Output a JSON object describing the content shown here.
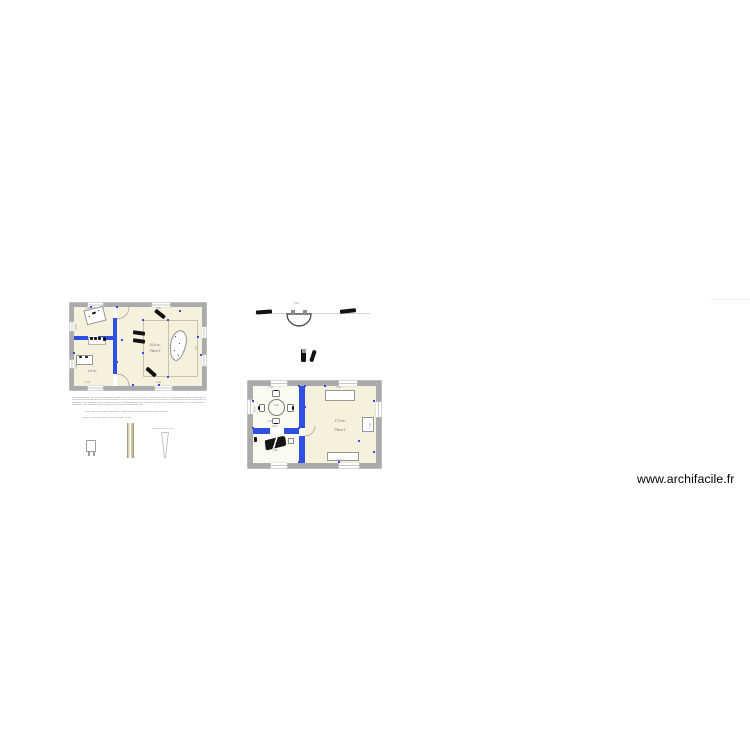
{
  "watermark": {
    "text": "www.archifacile.fr"
  },
  "plan1": {
    "main_room": {
      "area": "16,6 m²",
      "name": "Pièce 2"
    },
    "bottom_room": {
      "area": "4,9 m²"
    },
    "dims": {
      "top_left": "3,43",
      "top_right": "4,06",
      "bottom_left": "3,43",
      "bottom_right": "4,06",
      "left_top": "2,61",
      "left_bottom": "3,81",
      "right_side": "7,02"
    }
  },
  "plan2": {
    "table_room": {
      "dim_top": "2,96",
      "table_label": "1,10",
      "dim_bottom": "2,96"
    },
    "piano_room": {
      "door_label": "0,80",
      "label": "1,50"
    },
    "main_room": {
      "area": "17,9 m²",
      "name": "Pièce 3",
      "dim_top": "3,80",
      "dim_bottom": "3,80",
      "dim_left": "2,77",
      "dim_right": "5,06"
    }
  },
  "basin": {
    "dim": "0,60"
  },
  "annotations": {
    "lines": [
      "Plan de l'existant : les cloisons figurées en bleu sont à créer, les murs gris correspondent aux murs porteurs existants conservés en l'état lors des travaux de rénovation.",
      "Les menuiseries extérieures sont conservées. Prévoir la dépose de la cloison entre la cuisine et le séjour ainsi que la reprise des sols au droit des cloisons déposées.",
      "Les cotes sont données à titre indicatif et devront impérativement être vérifiées sur place par l'entreprise avant tout commencement des travaux.",
      "Document non contractuel établi d'après les relevés effectués sur site."
    ],
    "caption1": "Plan coté du rez-de-chaussée — état projeté après démolition des cloisons",
    "caption2": "Détail : coffre de volet roulant existant conservé",
    "caption3": "Étai de soutien provisoire"
  }
}
